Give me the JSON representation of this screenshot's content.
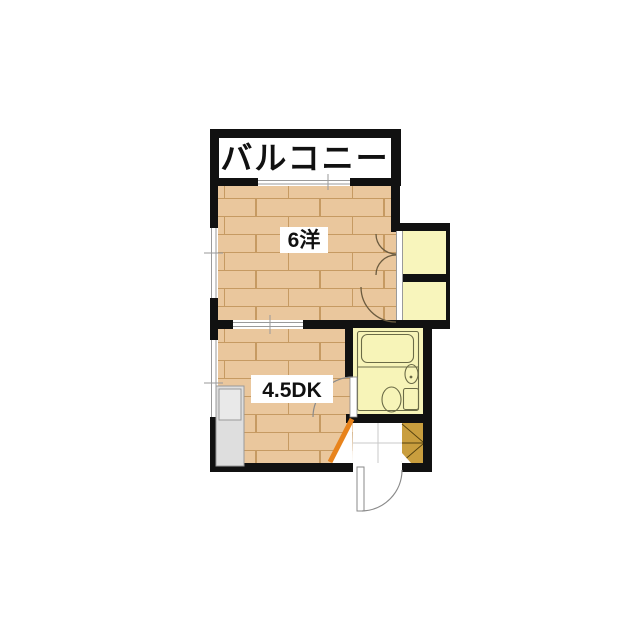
{
  "floorplan": {
    "labels": {
      "balcony": "バルコニー",
      "western_room": "6洋",
      "dining_kitchen": "4.5DK"
    },
    "colors": {
      "background": "#FFFFFF",
      "wall": "#111111",
      "wood_floor": "#EAC79D",
      "wood_line": "#C69A62",
      "closet_yellow": "#F8F5BC",
      "closet_edge": "#D9D194",
      "bath_yellow": "#F7F4B8",
      "fixture_line": "#6B6B47",
      "cabinet": "#C99E3E",
      "cabinet_line": "#55420F",
      "orange_door": "#E8831C",
      "counter": "#DEDEDE",
      "counter_line": "#999999",
      "door_line": "#8A8A8A",
      "window_line": "#9A9A9A",
      "tile_line": "#C8C8C8"
    }
  }
}
